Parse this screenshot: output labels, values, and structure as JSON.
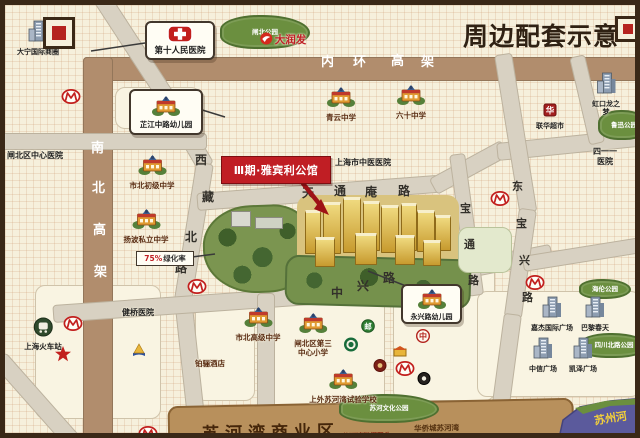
{
  "title": "周边配套示意",
  "banner": {
    "text": "Ⅲ期·雅宾利公馆"
  },
  "greening_label": {
    "percent": "75%",
    "suffix": "绿化率"
  },
  "roads": {
    "inner_ring": "内环高架",
    "north_south": "南北高架",
    "xizang_north": "西藏北路",
    "tiantongan": "天通庵路",
    "zhongxing": "中兴路",
    "dongbaoxing": "东宝兴路",
    "baotong": "宝通路"
  },
  "callouts": [
    {
      "id": "hospital-no10-callout",
      "icon": "cross",
      "text": "第十人民医院",
      "x": 140,
      "y": 16,
      "w": 66,
      "h": 35,
      "fs": 8.5,
      "pointer": [
        140,
        38,
        86,
        46
      ]
    },
    {
      "id": "zhijiang-kindergarten-callout",
      "icon": "school",
      "text": "芷江中路幼儿园",
      "x": 124,
      "y": 84,
      "w": 70,
      "h": 42,
      "fs": 7.5,
      "pointer": [
        194,
        104,
        220,
        112
      ]
    },
    {
      "id": "yongxing-kindergarten-callout",
      "icon": "school",
      "text": "永兴路幼儿园",
      "x": 396,
      "y": 279,
      "w": 57,
      "h": 36,
      "fs": 7,
      "pointer": [
        401,
        281,
        363,
        266
      ]
    }
  ],
  "pois": [
    {
      "id": "qingyun-middle-school",
      "type": "school",
      "x": 336,
      "y": 80,
      "label": "青云中学"
    },
    {
      "id": "no60-middle-school",
      "type": "school",
      "x": 406,
      "y": 78,
      "label": "六十中学"
    },
    {
      "id": "shibei-junior-high",
      "type": "school",
      "x": 147,
      "y": 148,
      "label": "市北初级中学"
    },
    {
      "id": "yangbo-private-school",
      "type": "school",
      "x": 141,
      "y": 202,
      "label": "扬波私立中学"
    },
    {
      "id": "shibei-senior-high",
      "type": "school",
      "x": 253,
      "y": 300,
      "label": "市北高级中学"
    },
    {
      "id": "zhabei-no3-primary-school",
      "type": "school",
      "x": 308,
      "y": 306,
      "label": "闸北区第三\n中心小学"
    },
    {
      "id": "sisu-suhewan-school",
      "type": "school",
      "x": 338,
      "y": 362,
      "label": "上外苏河湾试验学校"
    },
    {
      "id": "zhabei-central-hospital",
      "type": "hospital",
      "x": 30,
      "y": 145,
      "label": "闸北区中心医院"
    },
    {
      "id": "shanghai-tcm-hospital",
      "type": "hospital",
      "x": 358,
      "y": 152,
      "label": "上海市中医医院"
    },
    {
      "id": "hospital-411",
      "type": "hospital",
      "x": 600,
      "y": 141,
      "label": "四一一医院"
    },
    {
      "id": "jianqiao-hospital",
      "type": "hospital",
      "x": 133,
      "y": 302,
      "label": "健桥医院"
    },
    {
      "id": "metro-station-1",
      "type": "metro",
      "x": 66,
      "y": 84
    },
    {
      "id": "metro-station-2",
      "type": "metro",
      "x": 192,
      "y": 274
    },
    {
      "id": "metro-station-3",
      "type": "metro",
      "x": 495,
      "y": 186
    },
    {
      "id": "metro-station-4",
      "type": "metro",
      "x": 530,
      "y": 270
    },
    {
      "id": "metro-station-5",
      "type": "metro",
      "x": 400,
      "y": 356
    },
    {
      "id": "metro-station-6",
      "type": "metro",
      "x": 68,
      "y": 311
    },
    {
      "id": "metro-station-7",
      "type": "metro",
      "x": 143,
      "y": 421
    },
    {
      "id": "rt-mart",
      "type": "rtmart",
      "x": 278,
      "y": 25,
      "label": "大润发"
    },
    {
      "id": "lianhua-supermarket",
      "type": "lianhua",
      "x": 545,
      "y": 97,
      "label": "联华超市"
    },
    {
      "id": "starbucks",
      "type": "starbucks",
      "x": 346,
      "y": 332
    },
    {
      "id": "bank-of-china",
      "type": "boc",
      "x": 418,
      "y": 323
    },
    {
      "id": "china-post-bank",
      "type": "post",
      "x": 363,
      "y": 313
    },
    {
      "id": "street-shop",
      "type": "shop",
      "x": 395,
      "y": 337
    },
    {
      "id": "brand-darkred",
      "type": "dot",
      "x": 375,
      "y": 352
    },
    {
      "id": "brand-black",
      "type": "dotblack",
      "x": 419,
      "y": 365
    },
    {
      "id": "brand-pyramid",
      "type": "pyramid",
      "x": 134,
      "y": 337
    },
    {
      "id": "brand-orange-partial",
      "type": "shop",
      "x": 176,
      "y": 424
    },
    {
      "id": "daning-commercial-circle",
      "type": "building",
      "x": 33,
      "y": 14,
      "label": "大宁国际商圈"
    },
    {
      "id": "hongkou-longemont",
      "type": "building",
      "x": 601,
      "y": 66,
      "label": "虹口龙之梦"
    },
    {
      "id": "jiajie-intl-plaza",
      "type": "building",
      "x": 547,
      "y": 290,
      "label": "嘉杰国际广场"
    },
    {
      "id": "printemps",
      "type": "building",
      "x": 590,
      "y": 290,
      "label": "巴黎春天"
    },
    {
      "id": "zhongxin-plaza",
      "type": "building",
      "x": 538,
      "y": 331,
      "label": "中信广场"
    },
    {
      "id": "kaize-plaza",
      "type": "building",
      "x": 578,
      "y": 331,
      "label": "凯泽广场"
    },
    {
      "id": "qube-hotel",
      "type": "textonly",
      "x": 205,
      "y": 353,
      "label": "铂骊酒店"
    },
    {
      "id": "shanghai-railway-station",
      "type": "station",
      "x": 38,
      "y": 312,
      "label": "上海火车站"
    },
    {
      "id": "red-star",
      "type": "star",
      "x": 58,
      "y": 340
    },
    {
      "id": "park-zhabei",
      "type": "park",
      "x": 258,
      "y": 25,
      "w": 86,
      "h": 30,
      "label": "闸北公园"
    },
    {
      "id": "park-luxun",
      "type": "park",
      "x": 617,
      "y": 118,
      "w": 48,
      "h": 26,
      "label": "鲁迅公园"
    },
    {
      "id": "park-hailun",
      "type": "park",
      "x": 598,
      "y": 282,
      "w": 48,
      "h": 16,
      "label": "海伦公园"
    },
    {
      "id": "park-sichuan-north",
      "type": "park",
      "x": 607,
      "y": 338,
      "w": 64,
      "h": 21,
      "label": "四川北路公园"
    },
    {
      "id": "park-suhe-culture",
      "type": "park",
      "x": 382,
      "y": 401,
      "w": 96,
      "h": 25,
      "label": "苏河文化公园"
    }
  ],
  "bottom": {
    "business_district": "苏河湾商业区",
    "dock": "苏河湾游艇码头",
    "oct": "华侨城苏河湾",
    "river": "苏州河"
  },
  "icon_glyphs": {
    "boc": "中",
    "post": "邮",
    "lianhua": "华"
  },
  "colors": {
    "accent_red": "#c01e24",
    "elevated_road": "#b18d6d",
    "road": "#d8d1c2",
    "band": "#b8905c",
    "water": "#5b5a9c",
    "park": "#6b8f3f",
    "bg": "#f6f0dc"
  }
}
